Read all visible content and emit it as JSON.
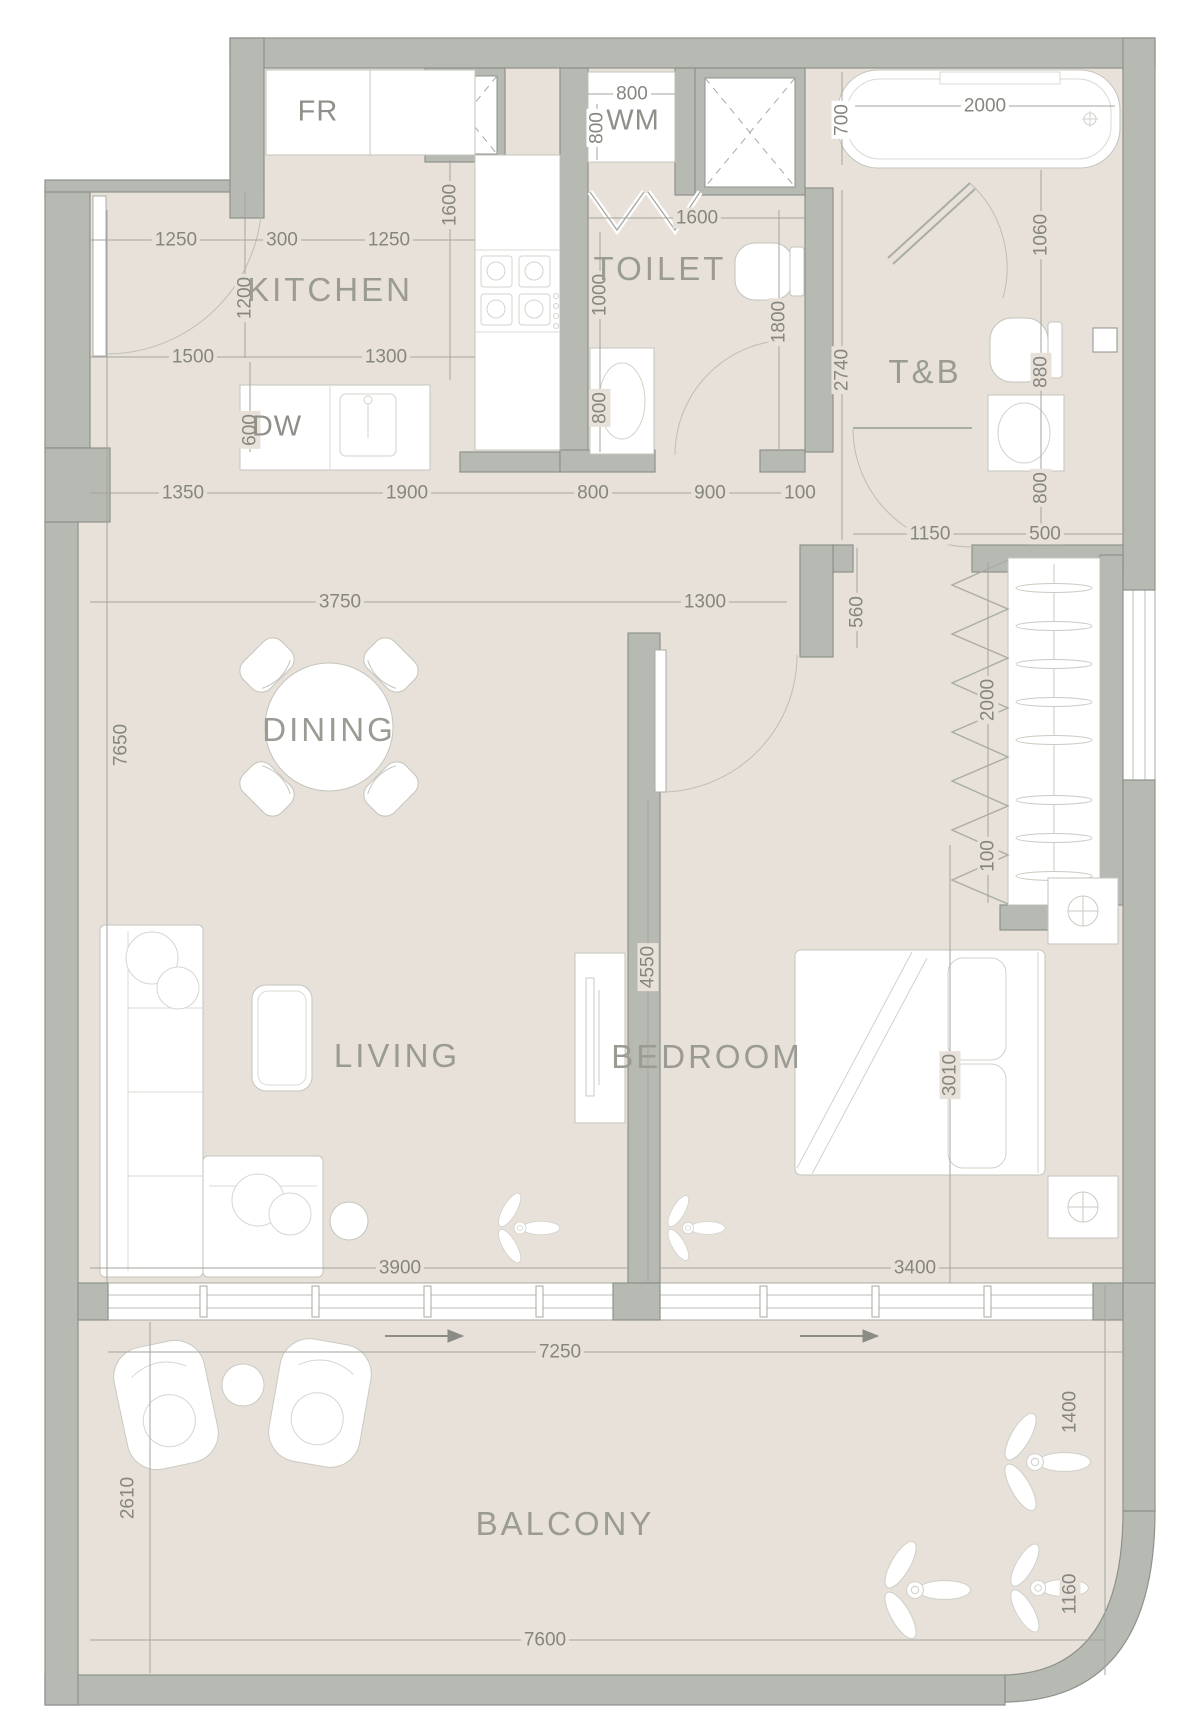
{
  "colors": {
    "floor": "#e8e1da",
    "wall_fill": "#b7bab2",
    "wall_stroke": "#8d928b",
    "furniture_stroke": "#c3c5bd",
    "dim_line": "#a3a49d",
    "text": "#85877f",
    "room_text": "#9a9b93",
    "white": "#ffffff"
  },
  "rooms": [
    {
      "id": "kitchen",
      "label": "KITCHEN",
      "x": 330,
      "y": 290
    },
    {
      "id": "toilet",
      "label": "TOILET",
      "x": 660,
      "y": 269
    },
    {
      "id": "tb",
      "label": "T&B",
      "x": 925,
      "y": 372
    },
    {
      "id": "dining",
      "label": "DINING",
      "x": 329,
      "y": 730
    },
    {
      "id": "living",
      "label": "LIVING",
      "x": 397,
      "y": 1056
    },
    {
      "id": "bedroom",
      "label": "BEDROOM",
      "x": 707,
      "y": 1057
    },
    {
      "id": "balcony",
      "label": "BALCONY",
      "x": 565,
      "y": 1524
    }
  ],
  "fixture_labels": [
    {
      "id": "fridge",
      "label": "FR",
      "x": 318,
      "y": 112
    },
    {
      "id": "washing-machine",
      "label": "WM",
      "x": 633,
      "y": 121
    },
    {
      "id": "dishwasher",
      "label": "DW",
      "x": 277,
      "y": 427
    }
  ],
  "dimensions": [
    {
      "v": "1250",
      "x": 176,
      "y": 240,
      "o": "h"
    },
    {
      "v": "300",
      "x": 282,
      "y": 240,
      "o": "h"
    },
    {
      "v": "1250",
      "x": 389,
      "y": 240,
      "o": "h"
    },
    {
      "v": "1500",
      "x": 193,
      "y": 357,
      "o": "h"
    },
    {
      "v": "1300",
      "x": 386,
      "y": 357,
      "o": "h"
    },
    {
      "v": "800",
      "x": 632,
      "y": 94,
      "o": "h",
      "bg": "white"
    },
    {
      "v": "1600",
      "x": 697,
      "y": 218,
      "o": "h"
    },
    {
      "v": "2000",
      "x": 985,
      "y": 106,
      "o": "h",
      "bg": "white"
    },
    {
      "v": "1350",
      "x": 183,
      "y": 493,
      "o": "h"
    },
    {
      "v": "1900",
      "x": 407,
      "y": 493,
      "o": "h"
    },
    {
      "v": "800",
      "x": 593,
      "y": 493,
      "o": "h"
    },
    {
      "v": "900",
      "x": 710,
      "y": 493,
      "o": "h"
    },
    {
      "v": "100",
      "x": 800,
      "y": 493,
      "o": "h"
    },
    {
      "v": "3750",
      "x": 340,
      "y": 602,
      "o": "h"
    },
    {
      "v": "1300",
      "x": 705,
      "y": 602,
      "o": "h"
    },
    {
      "v": "1150",
      "x": 930,
      "y": 534,
      "o": "h"
    },
    {
      "v": "500",
      "x": 1045,
      "y": 534,
      "o": "h"
    },
    {
      "v": "3900",
      "x": 400,
      "y": 1268,
      "o": "h"
    },
    {
      "v": "3400",
      "x": 915,
      "y": 1268,
      "o": "h"
    },
    {
      "v": "7250",
      "x": 560,
      "y": 1352,
      "o": "h"
    },
    {
      "v": "7600",
      "x": 545,
      "y": 1640,
      "o": "h"
    },
    {
      "v": "1600",
      "x": 450,
      "y": 205,
      "o": "v"
    },
    {
      "v": "1200",
      "x": 245,
      "y": 298,
      "o": "v"
    },
    {
      "v": "600",
      "x": 250,
      "y": 430,
      "o": "v"
    },
    {
      "v": "800",
      "x": 597,
      "y": 128,
      "o": "v",
      "bg": "white"
    },
    {
      "v": "1000",
      "x": 600,
      "y": 295,
      "o": "v"
    },
    {
      "v": "800",
      "x": 600,
      "y": 408,
      "o": "v"
    },
    {
      "v": "1800",
      "x": 779,
      "y": 322,
      "o": "v"
    },
    {
      "v": "700",
      "x": 842,
      "y": 120,
      "o": "v",
      "bg": "white"
    },
    {
      "v": "2740",
      "x": 842,
      "y": 370,
      "o": "v"
    },
    {
      "v": "1060",
      "x": 1041,
      "y": 235,
      "o": "v"
    },
    {
      "v": "880",
      "x": 1041,
      "y": 372,
      "o": "v"
    },
    {
      "v": "800",
      "x": 1041,
      "y": 488,
      "o": "v"
    },
    {
      "v": "560",
      "x": 857,
      "y": 612,
      "o": "v"
    },
    {
      "v": "2000",
      "x": 988,
      "y": 700,
      "o": "v"
    },
    {
      "v": "100",
      "x": 988,
      "y": 856,
      "o": "v"
    },
    {
      "v": "4550",
      "x": 648,
      "y": 967,
      "o": "v"
    },
    {
      "v": "3010",
      "x": 950,
      "y": 1075,
      "o": "v"
    },
    {
      "v": "7650",
      "x": 121,
      "y": 745,
      "o": "v"
    },
    {
      "v": "2610",
      "x": 128,
      "y": 1498,
      "o": "v"
    },
    {
      "v": "1400",
      "x": 1070,
      "y": 1412,
      "o": "v"
    },
    {
      "v": "1160",
      "x": 1070,
      "y": 1594,
      "o": "v"
    }
  ]
}
